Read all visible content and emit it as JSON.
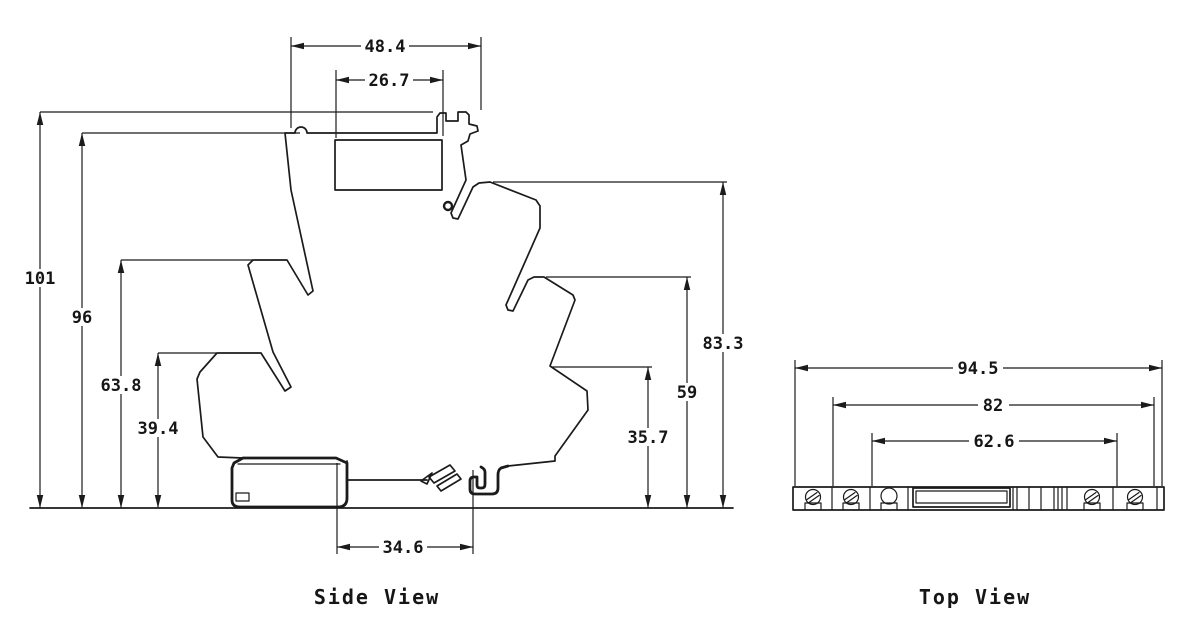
{
  "drawing_title": "Relay module dimensional drawing",
  "colors": {
    "line": "#1b1b1b",
    "background": "#ffffff"
  },
  "side_view": {
    "label": "Side View",
    "dims": {
      "top_width": "48.4",
      "socket_width": "26.7",
      "total_height": "101",
      "housing_height": "96",
      "mid_step_height": "63.8",
      "lower_step_height": "39.4",
      "right_upper_height": "83.3",
      "right_mid_height": "59",
      "right_lower_height": "35.7",
      "base_width": "34.6"
    }
  },
  "top_view": {
    "label": "Top View",
    "dims": {
      "overall_width": "94.5",
      "body_width": "82",
      "inner_width": "62.6"
    }
  }
}
